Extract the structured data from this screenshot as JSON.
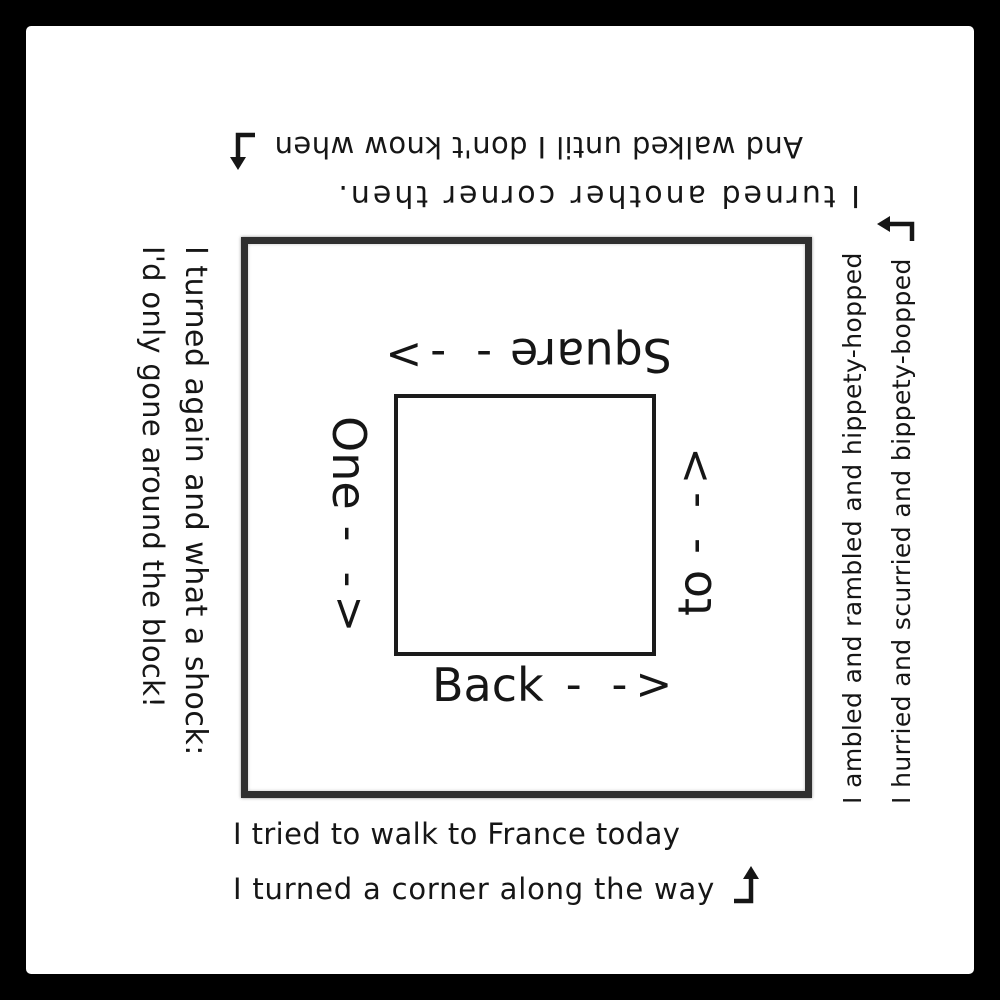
{
  "colors": {
    "ink": "#161616",
    "background": "#ffffff",
    "frame": "#000000",
    "outer_square_border": "#2f2f2f",
    "inner_square_border": "#1b1b1b"
  },
  "outer_poem": {
    "bottom": {
      "line1": "I tried to walk to France today",
      "line2": "I turned a corner along the way"
    },
    "right": {
      "line1": "I ambled and rambled and hippety-hopped",
      "line2": "I hurried and scurried and bippety-bopped"
    },
    "top": {
      "line1": "And walked until I don't know when",
      "line2": "I turned another corner then."
    },
    "left": {
      "line1": "I turned again and what a shock:",
      "line2": "I'd only gone around the block!"
    }
  },
  "inner_labels": {
    "bottom": {
      "word": "Back",
      "arrow": "- ->"
    },
    "right": {
      "word": "to",
      "arrow": "- ->"
    },
    "top": {
      "word": "Square",
      "arrow": "- ->"
    },
    "left": {
      "word": "One",
      "arrow": "- ->"
    }
  }
}
